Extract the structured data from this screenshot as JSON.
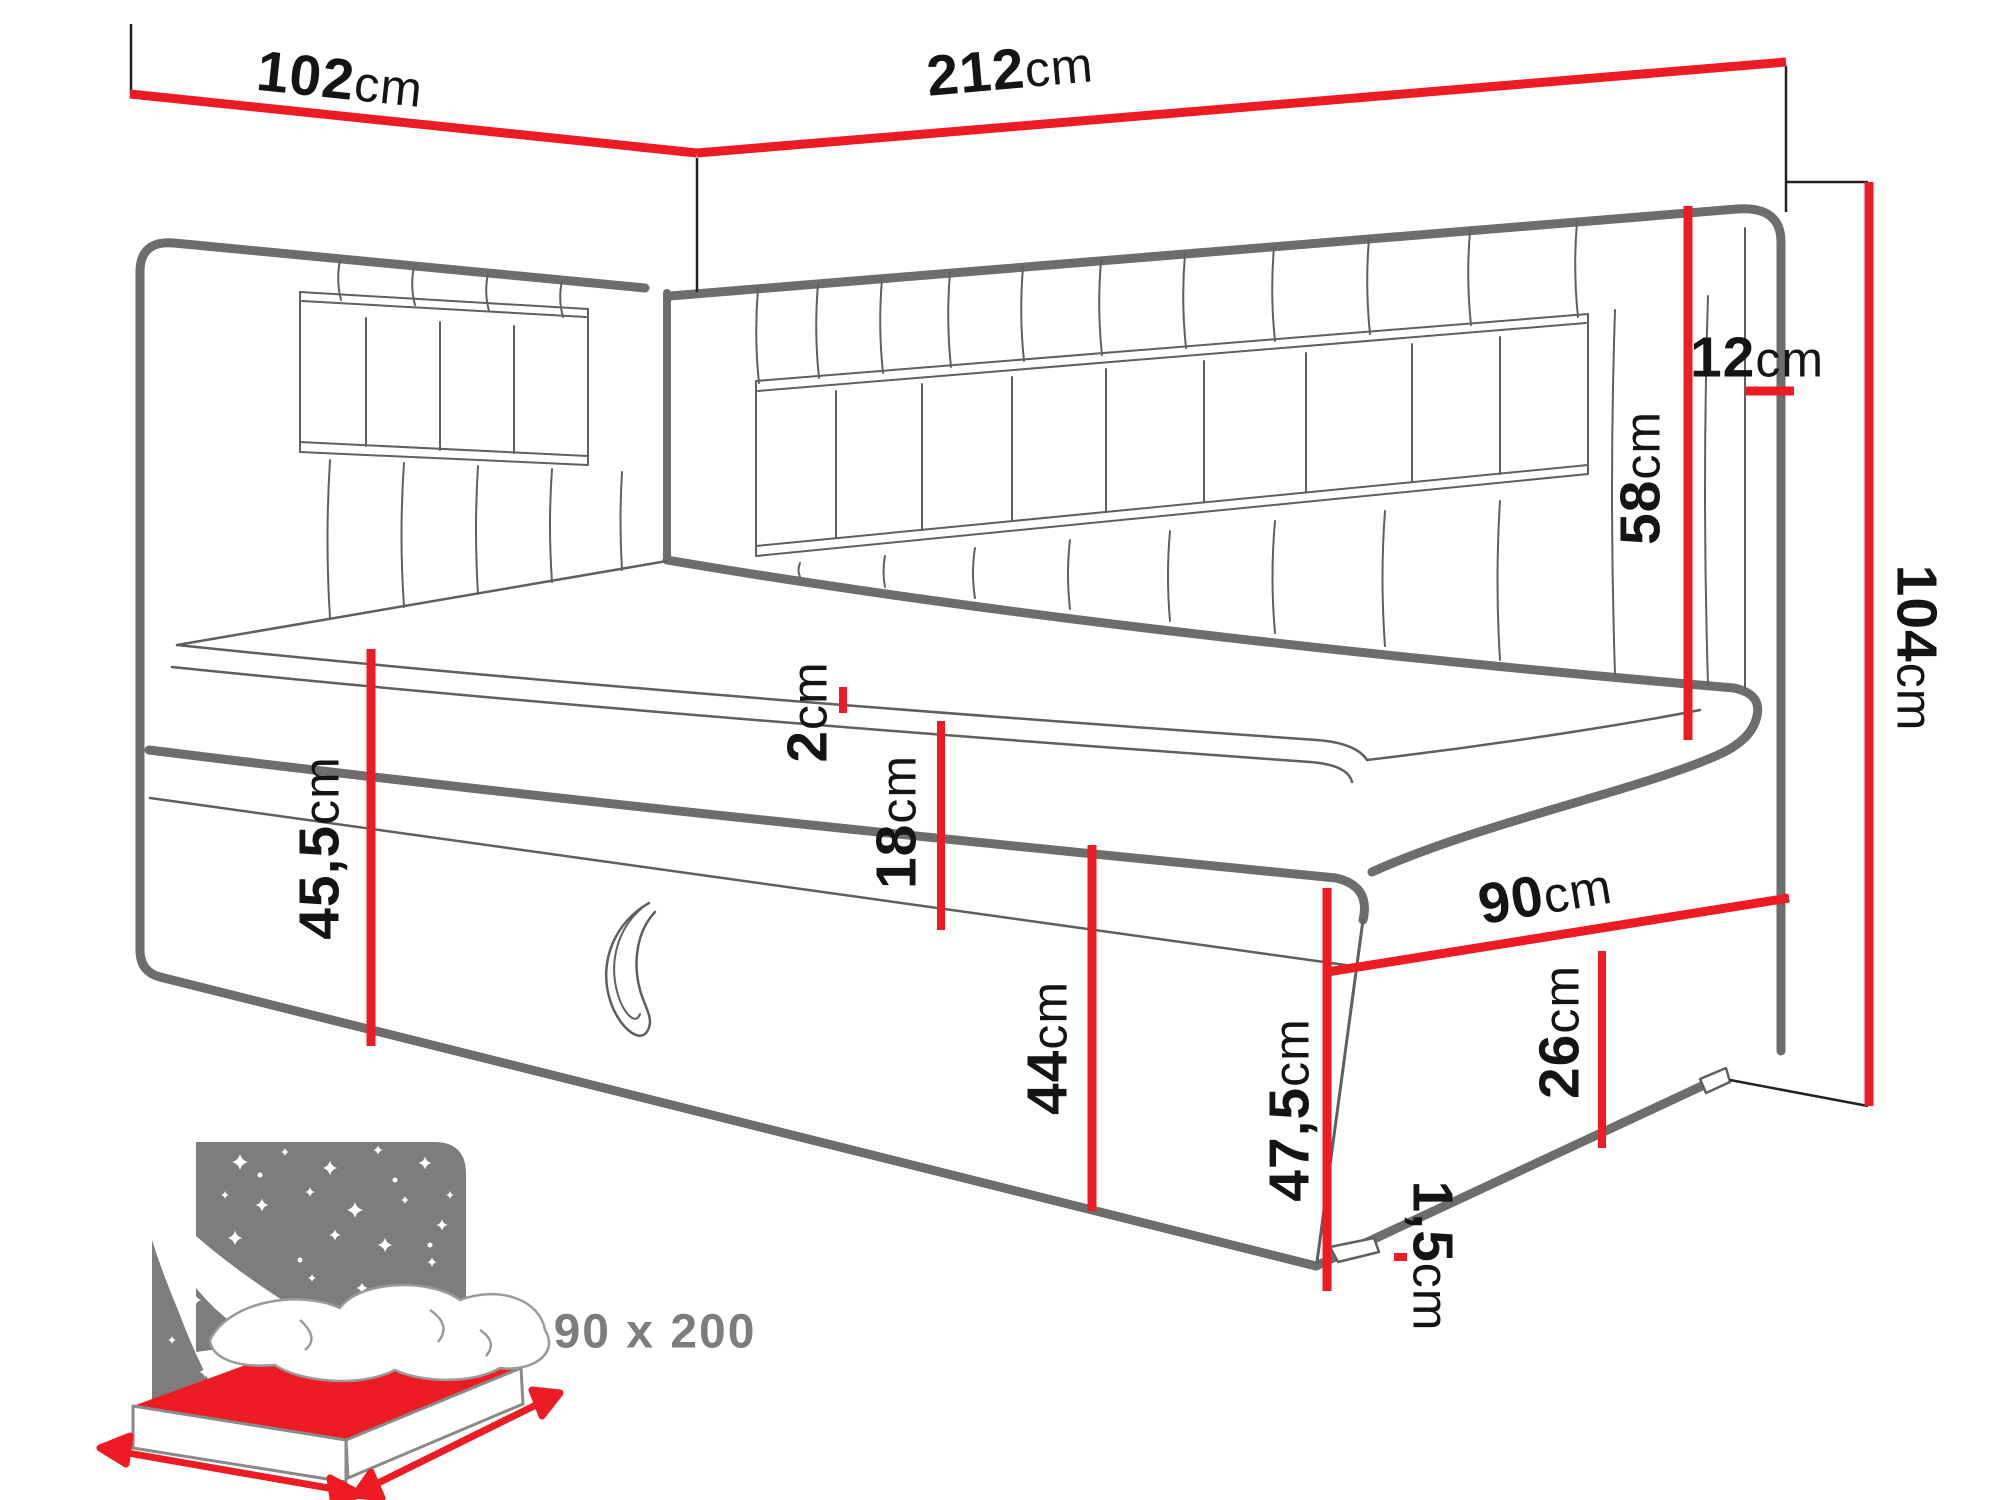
{
  "diagram": {
    "type": "furniture-dimension-drawing",
    "subject": "corner daybed with storage"
  },
  "dims": {
    "w102": {
      "num": "102",
      "unit": "cm"
    },
    "w212": {
      "num": "212",
      "unit": "cm"
    },
    "t12": {
      "num": "12",
      "unit": "cm"
    },
    "h58": {
      "num": "58",
      "unit": "cm"
    },
    "h104": {
      "num": "104",
      "unit": "cm"
    },
    "h2": {
      "num": "2",
      "unit": "cm"
    },
    "h18": {
      "num": "18",
      "unit": "cm"
    },
    "h45_5": {
      "num": "45,5",
      "unit": "cm"
    },
    "h44": {
      "num": "44",
      "unit": "cm"
    },
    "h47_5": {
      "num": "47,5",
      "unit": "cm"
    },
    "w90": {
      "num": "90",
      "unit": "cm"
    },
    "h26": {
      "num": "26",
      "unit": "cm"
    },
    "h1_5": {
      "num": "1,5",
      "unit": "cm"
    }
  },
  "inset": {
    "size_label": "90 x 200"
  },
  "colors": {
    "dimension_red": "#ed1c24",
    "line_gray": "#6d6d6d",
    "thin_gray": "#5f5f5f",
    "inset_gray": "#7d7d7d",
    "text_black": "#141414"
  }
}
